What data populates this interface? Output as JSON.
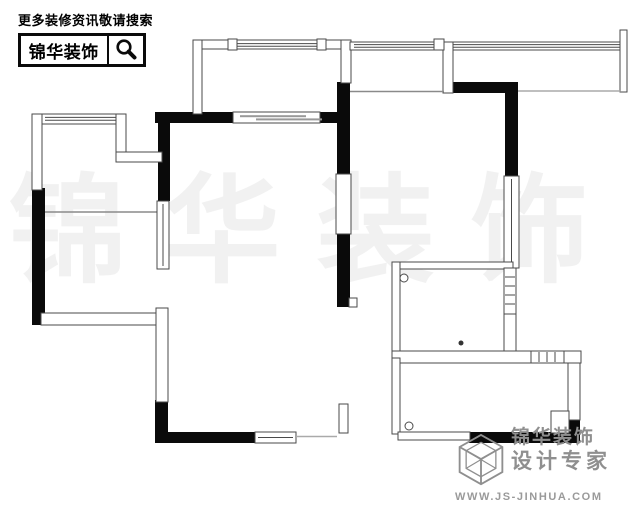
{
  "header": {
    "tagline": "更多装修资讯敬请搜索",
    "brand": "锦华装饰"
  },
  "watermark": {
    "text": "锦华装饰"
  },
  "footer": {
    "brand": "锦华装饰",
    "slogan": "设计专家",
    "website": "WWW.JS-JINHUA.COM"
  },
  "floorplan": {
    "type": "apartment floor plan drawing",
    "wall_color": "#0a0a0a",
    "thin_wall_color": "#4a4a4a",
    "logo_gray": "#8f8f8f"
  }
}
